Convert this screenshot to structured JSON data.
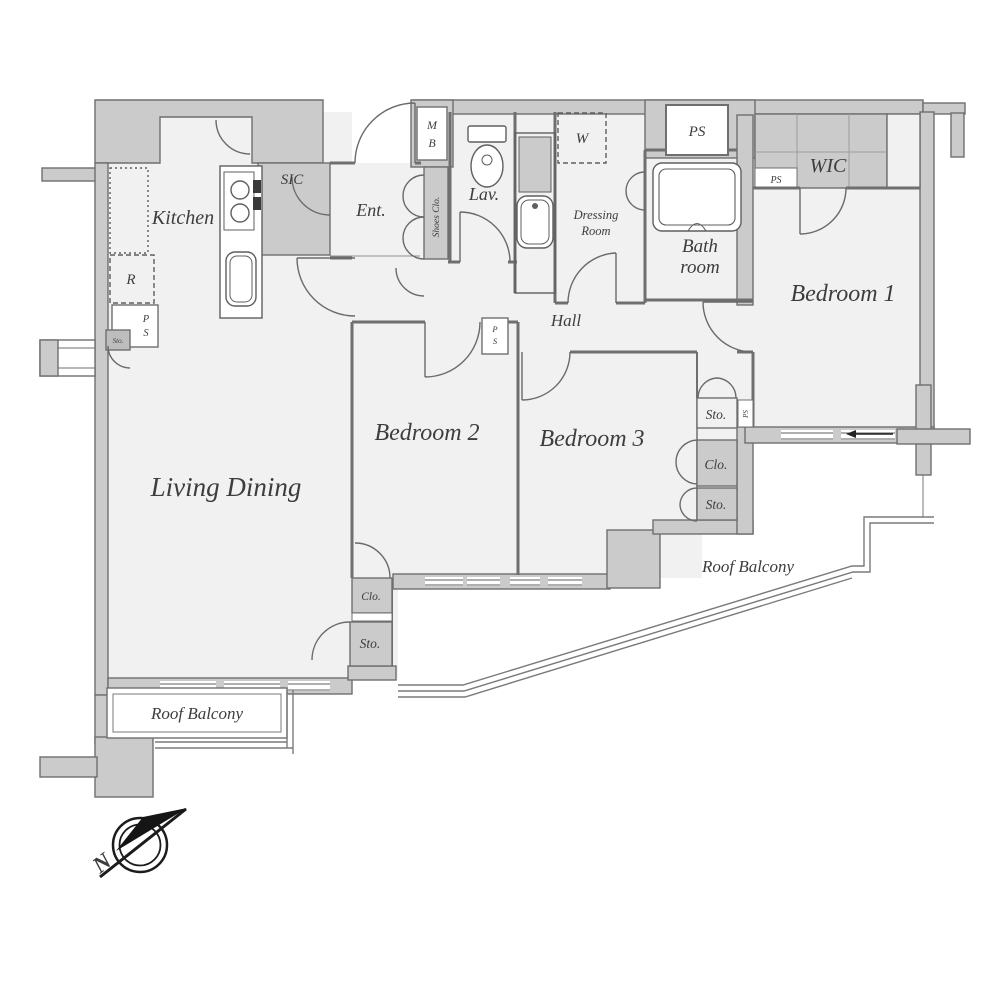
{
  "palette": {
    "wall_fill": "#cbcbcb",
    "wall_line": "#6f6f6f",
    "floor_fill": "#f1f1f1",
    "text_color": "#3d3d3d",
    "railing_line": "#7a7a7a",
    "compass_color": "#1c1c1c"
  },
  "plan": {
    "rooms": {
      "kitchen": "Kitchen",
      "sic": "SIC",
      "entrance": "Ent.",
      "lavatory": "Lav.",
      "dressing_line1": "Dressing",
      "dressing_line2": "Room",
      "bathroom_line1": "Bath",
      "bathroom_line2": "room",
      "wic": "WIC",
      "bedroom1": "Bedroom 1",
      "bedroom2": "Bedroom 2",
      "bedroom3": "Bedroom 3",
      "hall": "Hall",
      "living_dining": "Living Dining",
      "roof_balcony_left": "Roof Balcony",
      "roof_balcony_right": "Roof Balcony"
    },
    "utilities": {
      "mb_line1": "M",
      "mb_line2": "B",
      "ps_top": "PS",
      "ps_wic": "PS",
      "ps_kitchen_line1": "P",
      "ps_kitchen_line2": "S",
      "ps_hall_line1": "P",
      "ps_hall_line2": "S",
      "ps_column": "PS",
      "shoes_closet": "Shoes Clo.",
      "washer": "W",
      "refrigerator": "R",
      "sto_right_top": "Sto.",
      "clo_right": "Clo.",
      "sto_right_bottom": "Sto.",
      "clo_bedroom2": "Clo.",
      "sto_living": "Sto.",
      "sto_kitchen": "Sto."
    },
    "compass": {
      "north": "N"
    }
  }
}
